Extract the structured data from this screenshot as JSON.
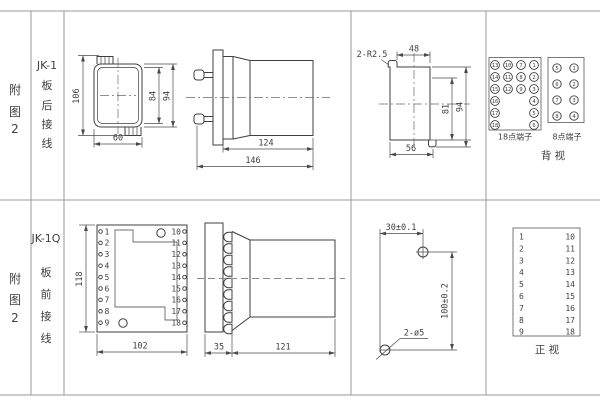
{
  "colors": {
    "grid": "#9a9a9a",
    "ink": "#3f3f3f",
    "dim": "#4a4a4a"
  },
  "rows": [
    {
      "figure_chars": [
        "附",
        "图",
        "2"
      ],
      "model": "JK-1",
      "wiring_chars": [
        "板",
        "后",
        "接",
        "线"
      ],
      "back_view": {
        "dim_height": "106",
        "dim_inner": "84",
        "dim_outer": "94",
        "dim_width": "60"
      },
      "side_view": {
        "dim_body": "124",
        "dim_total": "146"
      },
      "cutout": {
        "slot_label": "2-R2.5",
        "dim_top": "48",
        "dim_inner_h": "81",
        "dim_outer_h": "94",
        "dim_bottom": "56"
      },
      "terminals": {
        "t18_label": "18点端子",
        "t18_cols": [
          [
            "13",
            "14",
            "15",
            "16",
            "17",
            "18"
          ],
          [
            "10",
            "11",
            "12"
          ],
          [
            "7",
            "8",
            "9"
          ],
          [
            "1",
            "2",
            "3",
            "4",
            "5",
            "6"
          ]
        ],
        "t8_label": "8点端子",
        "t8_cols": [
          [
            "5",
            "6",
            "7",
            "8"
          ],
          [
            "1",
            "2",
            "3",
            "4"
          ]
        ],
        "view_label": "背  视"
      }
    },
    {
      "figure_chars": [
        "附",
        "图",
        "2"
      ],
      "model": "JK-1Q",
      "wiring_chars": [
        "板",
        "前",
        "接",
        "线"
      ],
      "front_view": {
        "dim_height": "118",
        "dim_width": "102",
        "left_terminals": [
          "1",
          "2",
          "3",
          "4",
          "5",
          "6",
          "7",
          "8",
          "9"
        ],
        "right_terminals": [
          "10",
          "11",
          "12",
          "13",
          "14",
          "15",
          "16",
          "17",
          "18"
        ]
      },
      "side_view": {
        "dim_plate": "35",
        "dim_body": "121"
      },
      "drill": {
        "dim_h": "30±0.1",
        "dim_v": "100±0.2",
        "hole_label": "2-ø5"
      },
      "panel": {
        "left_numbers": [
          "1",
          "2",
          "3",
          "4",
          "5",
          "6",
          "7",
          "8",
          "9"
        ],
        "right_numbers": [
          "10",
          "11",
          "12",
          "13",
          "14",
          "15",
          "16",
          "17",
          "18"
        ],
        "view_label": "正  视"
      }
    }
  ]
}
